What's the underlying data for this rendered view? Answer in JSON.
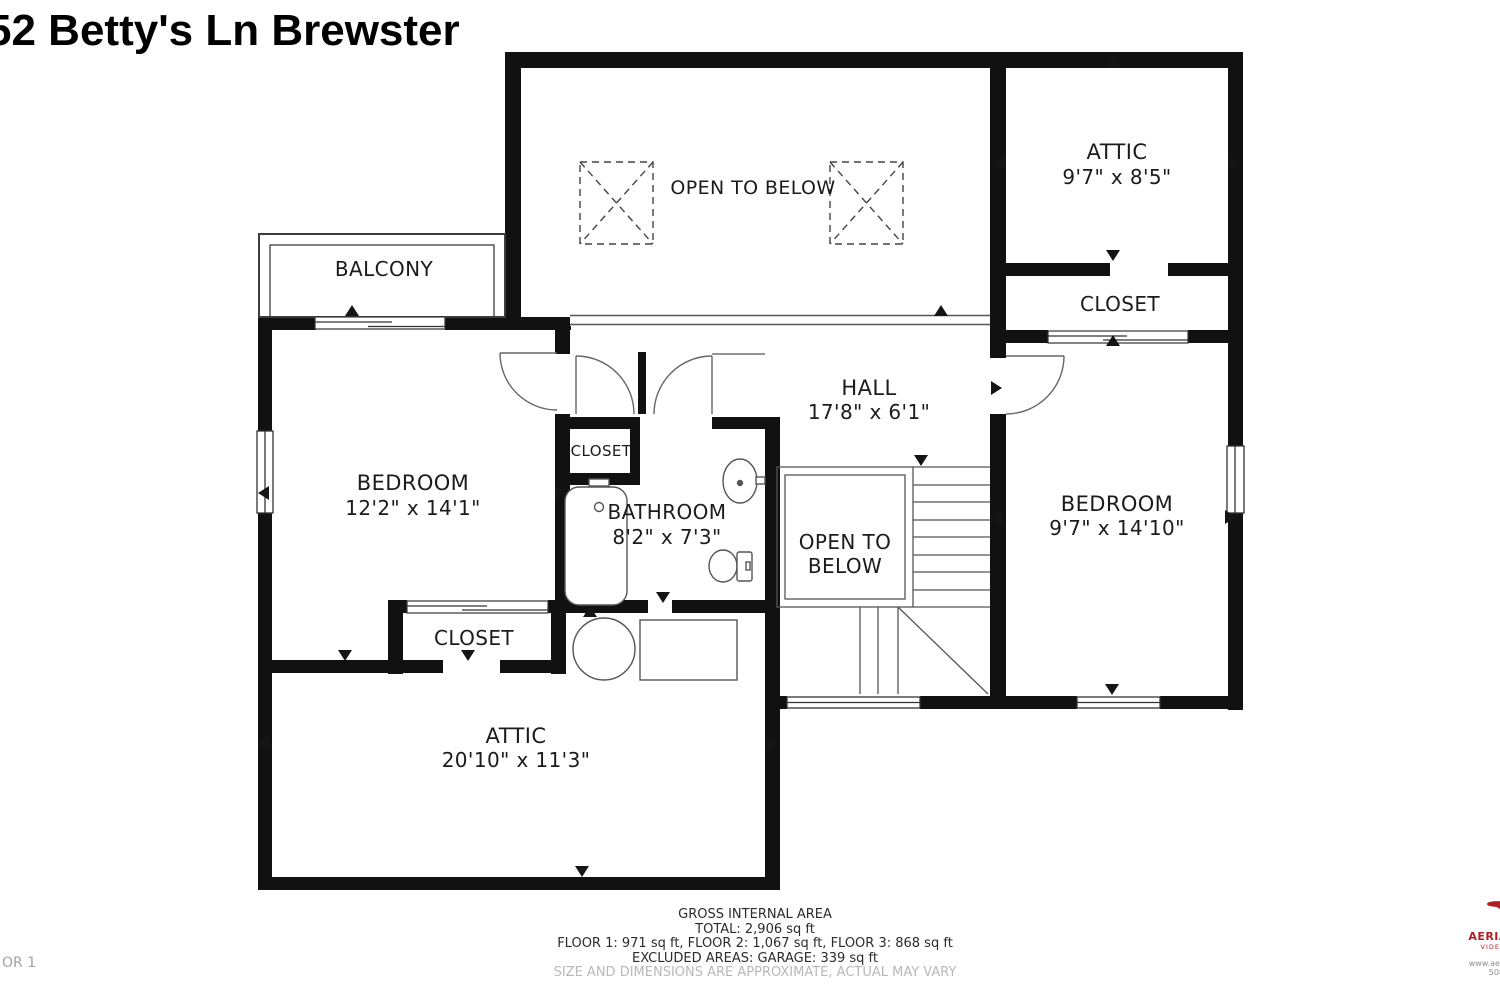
{
  "title": "52 Betty's Ln Brewster",
  "page_label": "OR 1",
  "rooms": {
    "open_to_below_top": {
      "name": "OPEN TO BELOW"
    },
    "attic_top_right": {
      "name": "ATTIC",
      "dims": "9'7\" x 8'5\""
    },
    "balcony": {
      "name": "BALCONY"
    },
    "closet_right": {
      "name": "CLOSET"
    },
    "hall": {
      "name": "HALL",
      "dims": "17'8\" x 6'1\""
    },
    "bedroom_left": {
      "name": "BEDROOM",
      "dims": "12'2\" x 14'1\""
    },
    "closet_center": {
      "name": "CLOSET"
    },
    "bathroom": {
      "name": "BATHROOM",
      "dims": "8'2\" x 7'3\""
    },
    "open_to_below_stairs": {
      "name": "OPEN TO BELOW"
    },
    "bedroom_right": {
      "name": "BEDROOM",
      "dims": "9'7\" x 14'10\""
    },
    "closet_bottom": {
      "name": "CLOSET"
    },
    "attic_bottom": {
      "name": "ATTIC",
      "dims": "20'10\" x 11'3\""
    }
  },
  "footer": {
    "heading": "GROSS INTERNAL AREA",
    "total": "TOTAL: 2,906 sq ft",
    "floors": "FLOOR 1: 971 sq ft, FLOOR 2: 1,067 sq ft, FLOOR 3: 868 sq ft",
    "excluded": "EXCLUDED AREAS: GARAGE: 339 sq ft",
    "disclaimer": "SIZE AND DIMENSIONS ARE APPROXIMATE, ACTUAL MAY VARY"
  },
  "logo": {
    "brand": "AERIAL ADVA",
    "tagline": "VIDEO | PHOTO",
    "website": "www.aerialadvantage",
    "phone": "508-419-61"
  },
  "colors": {
    "wall": "#111111",
    "thin_line": "#4a4a4a",
    "logo_red": "#b01e23"
  }
}
